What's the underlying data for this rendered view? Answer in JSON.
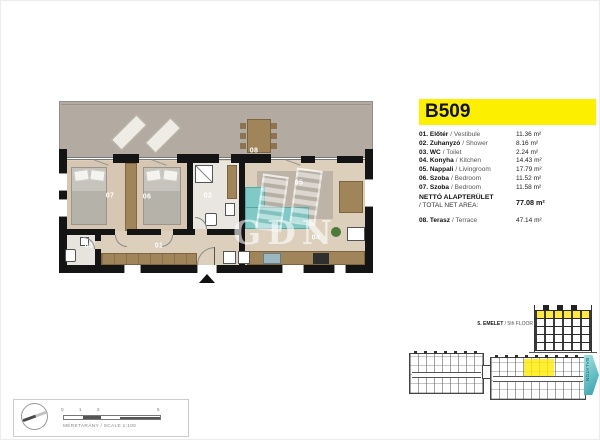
{
  "unit_header": {
    "code": "B509"
  },
  "legend": {
    "rooms": [
      {
        "num": "01.",
        "name_hu": "Előtér",
        "name_en": "/ Vestibule",
        "area": "11.36 m²"
      },
      {
        "num": "02.",
        "name_hu": "Zuhanyzó",
        "name_en": "/ Shower",
        "area": "8.16 m²"
      },
      {
        "num": "03.",
        "name_hu": "WC",
        "name_en": "/ Toilet",
        "area": "2.24 m²"
      },
      {
        "num": "04.",
        "name_hu": "Konyha",
        "name_en": "/ Kitchen",
        "area": "14.43 m²"
      },
      {
        "num": "05.",
        "name_hu": "Nappali",
        "name_en": "/ Livingroom",
        "area": "17.79 m²"
      },
      {
        "num": "06.",
        "name_hu": "Szoba",
        "name_en": "/ Bedroom",
        "area": "11.52 m²"
      },
      {
        "num": "07.",
        "name_hu": "Szoba",
        "name_en": "/ Bedroom",
        "area": "11.58 m²"
      }
    ],
    "total": {
      "label_hu": "NETTÓ ALAPTERÜLET",
      "label_en": "/ TOTAL NET AREA:",
      "area": "77.08 m²"
    },
    "terrace_row": {
      "num": "08.",
      "name_hu": "Terasz",
      "name_en": "/ Terrace",
      "area": "47.14 m²"
    }
  },
  "plan": {
    "labels": {
      "r01": "01",
      "r02": "02",
      "r03": "03",
      "r04": "04",
      "r05": "05",
      "r06": "06",
      "r07": "07",
      "r08": "08"
    }
  },
  "keyplan": {
    "floor_label_hu": "5. EMELET",
    "floor_label_en": "/ 5th FLOOR",
    "direction_label": "BALATON"
  },
  "footer": {
    "scale_label": "MÉRETARÁNY / SCALE  1:100",
    "scale_ticks": [
      "0",
      "1",
      "2",
      "5"
    ]
  },
  "watermark": {
    "text": "GDN"
  },
  "colors": {
    "highlight_yellow": "#fcf000",
    "sofa_teal": "#7fc9c7",
    "keyplan_unit_yellow": "#ffe93c",
    "direction_arrow_teal": "#4db8bf"
  }
}
